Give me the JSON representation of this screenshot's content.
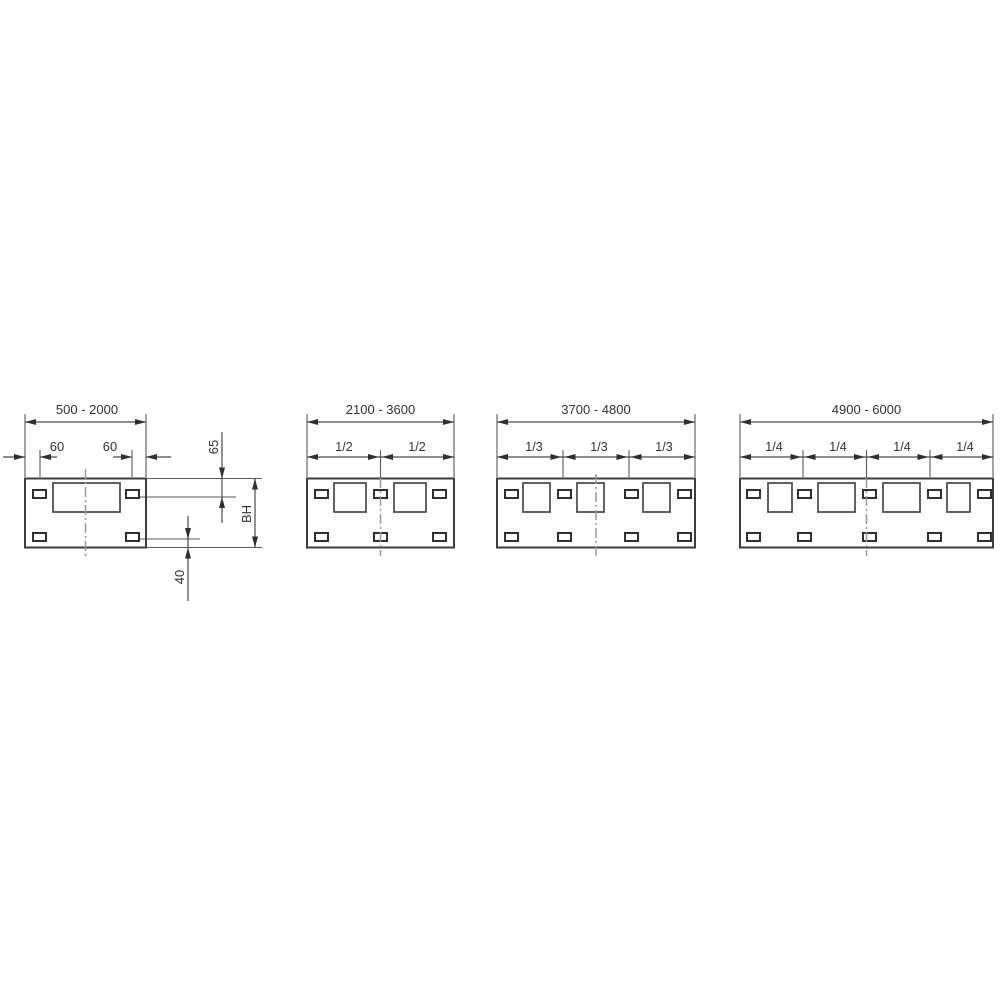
{
  "page": {
    "background": "#ffffff"
  },
  "drawing": {
    "type": "technical-dimension-diagram",
    "colors": {
      "line": "#3c3c3c",
      "dim_line": "#4a4a4a",
      "center_line": "#9a9a9a",
      "text": "#333333"
    },
    "diagrams": [
      {
        "range_label": "500 - 2000",
        "dim_labels": {
          "left_offset": "60",
          "right_offset": "60",
          "top_inset": "65",
          "body_height": "BH",
          "bottom_inset": "40"
        },
        "window_count": 1,
        "slot_count_top": 2,
        "slot_count_bottom": 2
      },
      {
        "range_label": "2100 - 3600",
        "fraction_labels": [
          "1/2",
          "1/2"
        ],
        "window_count": 2,
        "slot_count_top": 3,
        "slot_count_bottom": 3
      },
      {
        "range_label": "3700 - 4800",
        "fraction_labels": [
          "1/3",
          "1/3",
          "1/3"
        ],
        "window_count": 3,
        "slot_count_top": 4,
        "slot_count_bottom": 4
      },
      {
        "range_label": "4900 - 6000",
        "fraction_labels": [
          "1/4",
          "1/4",
          "1/4",
          "1/4"
        ],
        "window_count": 4,
        "slot_count_top": 5,
        "slot_count_bottom": 5
      }
    ]
  }
}
